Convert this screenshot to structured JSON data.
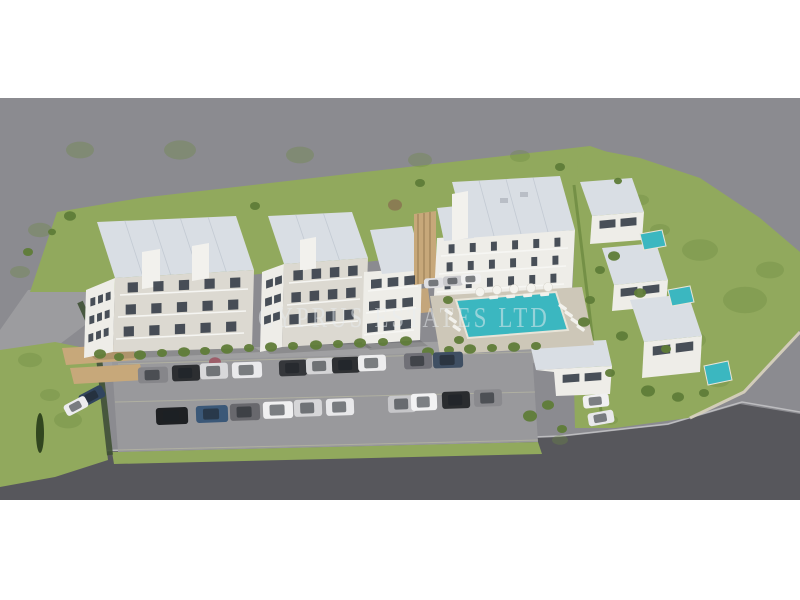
{
  "image": {
    "width": 800,
    "height": 600,
    "kind": "aerial 3D architectural rendering",
    "subject": "residential development with apartment blocks, detached villas, communal swimming pool and parking lot"
  },
  "watermark": {
    "text": "CYPRUS ESTATES LTD",
    "color": "#e9eef1",
    "opacity": 0.52
  },
  "palette": {
    "page_background": "#ffffff",
    "ground": "#8b8b90",
    "road_light": "#9c9c9f",
    "road_dark": "#57575c",
    "grass": "#91a95d",
    "grass_dark": "#6d8a41",
    "building_white": "#eeede8",
    "building_shade": "#dcd9d1",
    "roof": "#d9dee4",
    "window": "#39414b",
    "pool": "#3bb7c0",
    "wood": "#c7a87a",
    "hedge": "#3f5134",
    "deck": "#cdc7b8",
    "parking": "#99999c"
  },
  "scene": {
    "summary": {
      "apartment_blocks": 4,
      "detached_villas": 3,
      "communal_pools": 1,
      "private_villa_pools": 3,
      "parking_rows": 2,
      "cars_visible": 27,
      "pool_umbrellas": 5
    },
    "treeColor": "#5f7c38",
    "grassDark": "#6d8a41",
    "cars": [
      [
        153,
        375,
        30,
        16,
        -2,
        "#86868a"
      ],
      [
        186,
        373,
        28,
        16,
        -2,
        "#2c2e31"
      ],
      [
        214,
        371,
        28,
        16,
        -2,
        "#d8d8da"
      ],
      [
        247,
        370,
        30,
        16,
        -2,
        "#eaeaec"
      ],
      [
        293,
        368,
        28,
        16,
        -2,
        "#35373b"
      ],
      [
        320,
        366,
        28,
        16,
        -2,
        "#d4d4d6"
      ],
      [
        346,
        365,
        28,
        16,
        -2,
        "#2e3033"
      ],
      [
        372,
        363,
        28,
        16,
        -2,
        "#ededee"
      ],
      [
        418,
        361,
        28,
        16,
        -2,
        "#707077"
      ],
      [
        448,
        360,
        30,
        16,
        -2,
        "#3f4f63"
      ],
      [
        172,
        416,
        32,
        17,
        -2,
        "#1e2023"
      ],
      [
        212,
        414,
        32,
        17,
        -2,
        "#3b5878"
      ],
      [
        245,
        412,
        30,
        17,
        -2,
        "#68686d"
      ],
      [
        278,
        410,
        30,
        17,
        -2,
        "#f0f0f1"
      ],
      [
        308,
        408,
        28,
        17,
        -2,
        "#d6d6d8"
      ],
      [
        340,
        407,
        28,
        17,
        -2,
        "#e8e8ea"
      ],
      [
        402,
        404,
        28,
        17,
        -2,
        "#c6c6c9"
      ],
      [
        424,
        402,
        26,
        17,
        -2,
        "#f2f2f3"
      ],
      [
        456,
        400,
        28,
        17,
        -2,
        "#2a2c2f"
      ],
      [
        488,
        398,
        28,
        17,
        -2,
        "#8a8a8e"
      ],
      [
        92,
        396,
        26,
        13,
        -28,
        "#31455e"
      ],
      [
        76,
        406,
        24,
        12,
        -28,
        "#ececee"
      ],
      [
        596,
        401,
        26,
        13,
        -6,
        "#f0f0f1"
      ],
      [
        601,
        418,
        26,
        13,
        -10,
        "#e8e8ea"
      ],
      [
        434,
        283,
        20,
        10,
        -3,
        "#dfdfe2"
      ],
      [
        453,
        281,
        20,
        10,
        -3,
        "#c9c9cc"
      ],
      [
        471,
        279,
        20,
        10,
        -3,
        "#f0f0f0"
      ]
    ],
    "trees": [
      [
        100,
        354,
        6
      ],
      [
        119,
        357,
        5
      ],
      [
        140,
        355,
        6
      ],
      [
        162,
        353,
        5
      ],
      [
        184,
        352,
        6
      ],
      [
        205,
        351,
        5
      ],
      [
        227,
        349,
        6
      ],
      [
        249,
        348,
        5
      ],
      [
        271,
        347,
        6
      ],
      [
        293,
        346,
        5
      ],
      [
        316,
        345,
        6
      ],
      [
        338,
        344,
        5
      ],
      [
        360,
        343,
        6
      ],
      [
        383,
        342,
        5
      ],
      [
        406,
        341,
        6
      ],
      [
        428,
        352,
        6
      ],
      [
        449,
        350,
        5
      ],
      [
        470,
        349,
        6
      ],
      [
        492,
        348,
        5
      ],
      [
        514,
        347,
        6
      ],
      [
        536,
        346,
        5
      ],
      [
        448,
        300,
        5
      ],
      [
        459,
        340,
        5
      ],
      [
        584,
        322,
        6
      ],
      [
        590,
        300,
        5
      ],
      [
        614,
        256,
        6
      ],
      [
        600,
        270,
        5
      ],
      [
        640,
        293,
        6
      ],
      [
        622,
        336,
        6
      ],
      [
        666,
        349,
        5
      ],
      [
        648,
        391,
        7
      ],
      [
        678,
        397,
        6
      ],
      [
        704,
        393,
        5
      ],
      [
        610,
        373,
        5
      ],
      [
        70,
        216,
        6
      ],
      [
        255,
        206,
        5
      ],
      [
        420,
        183,
        5
      ],
      [
        560,
        167,
        5
      ],
      [
        618,
        181,
        4
      ],
      [
        530,
        416,
        7
      ],
      [
        548,
        405,
        6
      ],
      [
        562,
        429,
        5
      ],
      [
        28,
        252,
        5
      ],
      [
        52,
        232,
        4
      ],
      [
        395,
        205,
        7,
        "#8a7a52"
      ],
      [
        215,
        362,
        6,
        "#9c5a66"
      ]
    ],
    "grassBlobs": [
      [
        700,
        250,
        18
      ],
      [
        745,
        300,
        22
      ],
      [
        690,
        340,
        16
      ],
      [
        770,
        270,
        14
      ],
      [
        718,
        380,
        12
      ],
      [
        660,
        230,
        10
      ],
      [
        640,
        200,
        9
      ],
      [
        80,
        150,
        14
      ],
      [
        180,
        150,
        16
      ],
      [
        300,
        155,
        14
      ],
      [
        420,
        160,
        12
      ],
      [
        520,
        156,
        10
      ],
      [
        30,
        360,
        12
      ],
      [
        68,
        420,
        14
      ],
      [
        50,
        395,
        10
      ],
      [
        40,
        230,
        12
      ],
      [
        20,
        272,
        10
      ],
      [
        610,
        420,
        8
      ],
      [
        560,
        440,
        8
      ]
    ],
    "windowStrips": [
      [
        89,
        299,
        112,
        291,
        3,
        8,
        0
      ],
      [
        88,
        317,
        111,
        309,
        3,
        8,
        0
      ],
      [
        87,
        335,
        110,
        327,
        3,
        8,
        0
      ],
      [
        120,
        283,
        248,
        277,
        5,
        10,
        1
      ],
      [
        118,
        305,
        246,
        299,
        5,
        10,
        1
      ],
      [
        116,
        327,
        244,
        321,
        5,
        10,
        1
      ],
      [
        265,
        281,
        283,
        275,
        2,
        8,
        0
      ],
      [
        264,
        299,
        282,
        293,
        2,
        8,
        0
      ],
      [
        263,
        317,
        281,
        311,
        2,
        8,
        0
      ],
      [
        289,
        271,
        362,
        265,
        4,
        10,
        1
      ],
      [
        287,
        293,
        360,
        287,
        4,
        10,
        1
      ],
      [
        285,
        315,
        358,
        309,
        4,
        10,
        1
      ],
      [
        368,
        280,
        418,
        275,
        3,
        9,
        1
      ],
      [
        366,
        302,
        416,
        297,
        3,
        9,
        1
      ],
      [
        364,
        324,
        414,
        319,
        3,
        9,
        1
      ],
      [
        441,
        245,
        568,
        237,
        6,
        9,
        1
      ],
      [
        439,
        263,
        566,
        255,
        6,
        9,
        1
      ],
      [
        437,
        281,
        564,
        273,
        6,
        9,
        1
      ],
      [
        597,
        221,
        639,
        217,
        2,
        8,
        0
      ],
      [
        618,
        289,
        662,
        284,
        2,
        8,
        0
      ],
      [
        650,
        347,
        696,
        341,
        2,
        9,
        0
      ],
      [
        560,
        375,
        604,
        372,
        2,
        8,
        0
      ]
    ],
    "umbrellas": [
      [
        480,
        292
      ],
      [
        497,
        290
      ],
      [
        514,
        289
      ],
      [
        531,
        288
      ],
      [
        548,
        287
      ]
    ],
    "loungers": [
      [
        560,
        303,
        35
      ],
      [
        566,
        310,
        35
      ],
      [
        572,
        317,
        35
      ],
      [
        578,
        324,
        35
      ],
      [
        446,
        308,
        35
      ],
      [
        450,
        316,
        35
      ],
      [
        454,
        324,
        35
      ],
      [
        489,
        296,
        -5
      ],
      [
        506,
        295,
        -5
      ],
      [
        523,
        294,
        -5
      ],
      [
        540,
        293,
        -5
      ]
    ]
  }
}
